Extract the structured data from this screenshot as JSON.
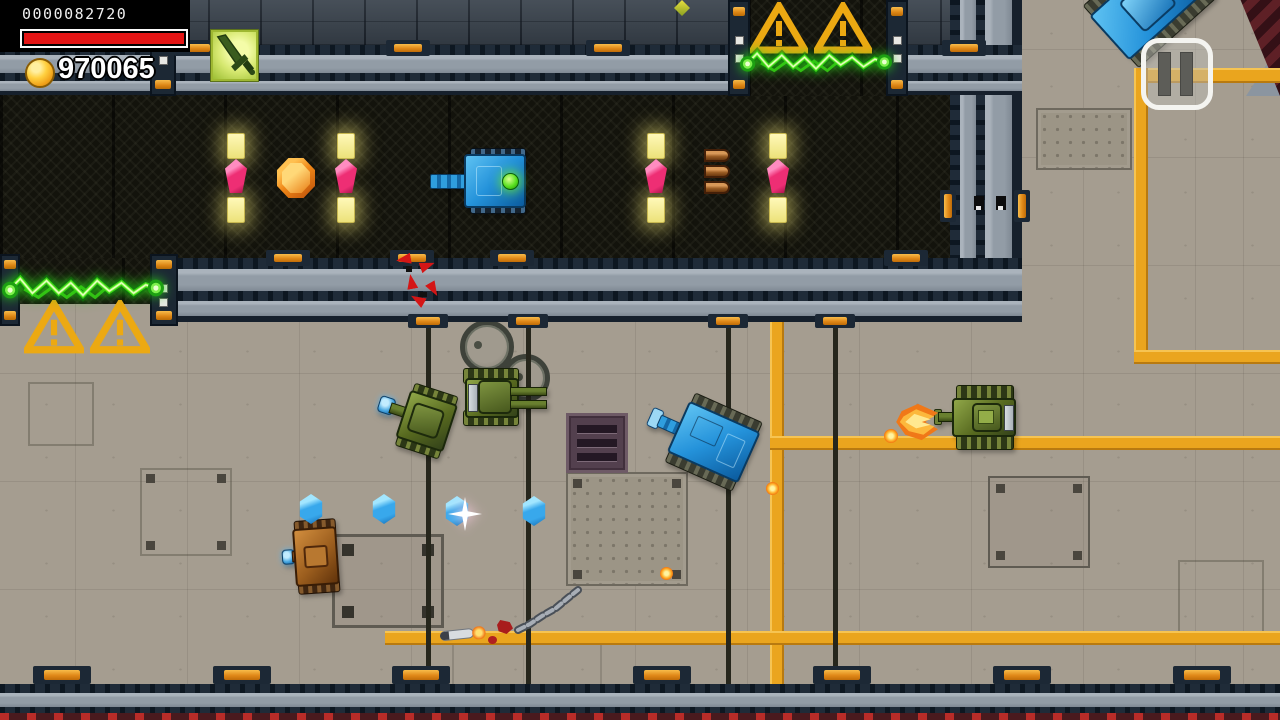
{
  "hud": {
    "score": "0000082720",
    "health": {
      "percent": 100,
      "color": "#e41414"
    },
    "coins": "970065",
    "icons": [
      "coin-icon"
    ]
  },
  "controls": {
    "pause_button": {
      "icon": "pause-icon"
    }
  },
  "pickups": {
    "sword_powerup": {
      "icon": "sword-icon",
      "frame_color": "#9fb832"
    },
    "ammo_bullets": {
      "count": 3,
      "color": "#9a5c24"
    },
    "orange_coin_gem": {
      "shape": "octagon",
      "color": "#f08818"
    },
    "pink_gems": {
      "count": 4,
      "color": "#ee2e74"
    },
    "blue_gems": {
      "count": 4,
      "color": "#38a8ec",
      "sparkling_index": 2
    },
    "corridor_lights": {
      "count": 8,
      "color": "#ece27a"
    },
    "partial_crystal_top": {
      "color": "#d8d020"
    }
  },
  "scene": {
    "tanks": [
      {
        "id": "corridor-blue-tank",
        "color": "blue",
        "facing": "left",
        "x": 430,
        "y": 148,
        "feature": "green-power-core"
      },
      {
        "id": "green-tank-left",
        "color": "green",
        "facing": "left",
        "x": 376,
        "y": 384,
        "feature": "blue-plasma-tip"
      },
      {
        "id": "green-tank-double-barrel",
        "color": "green",
        "facing": "right",
        "x": 462,
        "y": 366
      },
      {
        "id": "blue-tank-center",
        "color": "blue",
        "facing": "down-left",
        "x": 646,
        "y": 398
      },
      {
        "id": "brown-tank",
        "color": "brown",
        "facing": "left",
        "x": 282,
        "y": 520,
        "feature": "blue-plasma-tip"
      },
      {
        "id": "green-tank-firing",
        "color": "green",
        "facing": "left",
        "x": 934,
        "y": 381,
        "state": "firing-muzzle-flash"
      },
      {
        "id": "blue-tank-top-right",
        "color": "blue",
        "facing": "up-right",
        "x": 1092,
        "y": -40
      }
    ],
    "hazards": {
      "electric_fences": [
        {
          "id": "left-gate-fence",
          "color": "#36d414",
          "warning_triangles": 2
        },
        {
          "id": "top-gate-fence",
          "color": "#36d414",
          "warning_triangles": 2
        }
      ],
      "warning_color": "#eca912"
    },
    "projectiles": {
      "count": 3,
      "color": "#ffb028"
    },
    "debris": [
      "red-shards",
      "missile",
      "broken-track-chain",
      "red-splatter"
    ],
    "pipes_color": "#eaa51e",
    "wall_clip_color": "#e08818"
  }
}
